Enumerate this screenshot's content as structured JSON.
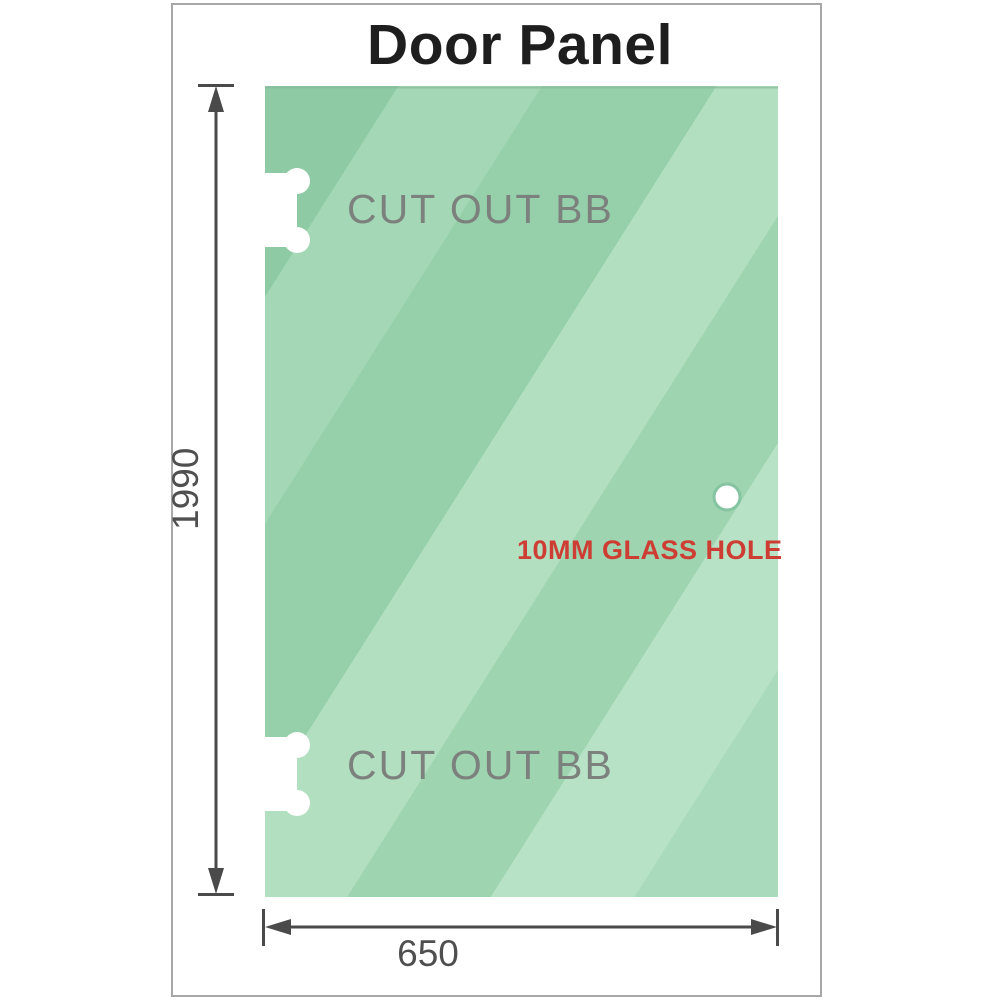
{
  "title": "Door Panel",
  "panel": {
    "cutout_label": "CUT OUT BB",
    "hole_label": "10MM GLASS HOLE"
  },
  "dimensions": {
    "height": "1990",
    "width": "650"
  },
  "colors": {
    "glass_base": "#9ed5b1",
    "glass_highlight": "#b8e2c6",
    "glass_shadow": "#8ecba5",
    "dimension_line": "#4a4a4a",
    "dimension_text": "#4f4f4f",
    "cutout_text": "#7c817e",
    "hole_text": "#ce3d34",
    "frame_border": "#a8a8a8",
    "hole_ring": "#84c4a0"
  }
}
